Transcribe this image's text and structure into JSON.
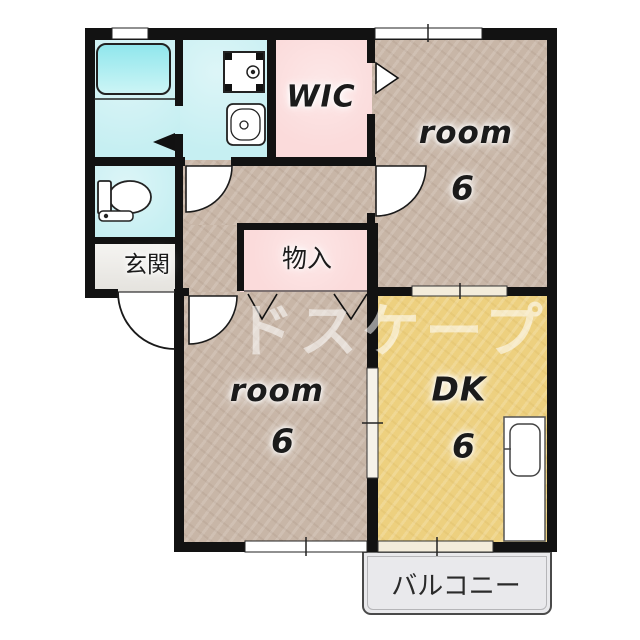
{
  "plan": {
    "watermark": "ドスケープ",
    "rooms": {
      "wic": {
        "label": "WIC"
      },
      "bedroom_top": {
        "label": "room",
        "size": "6"
      },
      "bedroom_bottom": {
        "label": "room",
        "size": "6"
      },
      "dining_kitchen": {
        "label": "DK",
        "size": "6"
      },
      "entrance": {
        "label": "玄関"
      },
      "storage": {
        "label": "物入"
      },
      "balcony": {
        "label": "バルコニー"
      }
    },
    "fixtures": [
      "bathtub",
      "washing-machine",
      "washbasin",
      "toilet",
      "kitchen-sink"
    ],
    "colors": {
      "room_floor": "#c8b6a7",
      "dk_floor": "#edd07f",
      "closet_pink": "#fbdbdb",
      "wet_area_cyan": "#c6eff2",
      "entrance_gray": "#eceae5",
      "balcony_gray": "#e9e9ec",
      "wall": "#121212"
    }
  }
}
